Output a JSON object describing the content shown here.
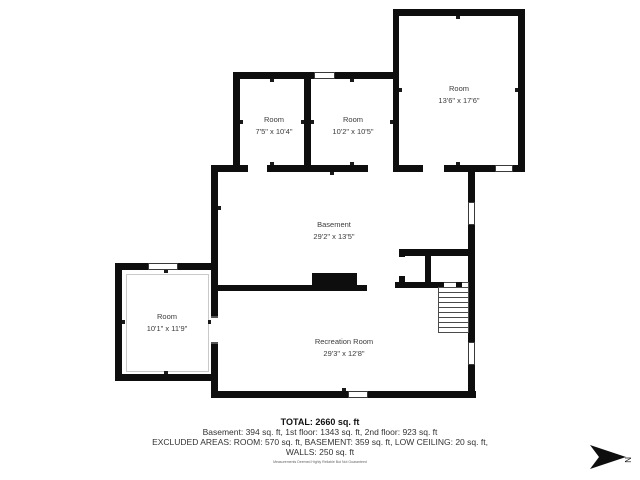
{
  "floorplan": {
    "rooms": [
      {
        "name": "Room",
        "dims": "7'5\" x 10'4\""
      },
      {
        "name": "Room",
        "dims": "10'2\" x 10'5\""
      },
      {
        "name": "Room",
        "dims": "13'6\" x 17'6\""
      },
      {
        "name": "Basement",
        "dims": "29'2\" x 13'5\""
      },
      {
        "name": "Room",
        "dims": "10'1\" x 11'9\""
      },
      {
        "name": "Recreation Room",
        "dims": "29'3\" x 12'8\""
      }
    ],
    "compass_label": "N",
    "colors": {
      "wall": "#0e0e0e",
      "label_text": "#3b3b3b"
    }
  },
  "summary": {
    "total": "TOTAL: 2660 sq. ft",
    "floors": "Basement: 394 sq. ft, 1st floor: 1343 sq. ft, 2nd floor: 923 sq. ft",
    "excluded": "EXCLUDED AREAS: ROOM: 570 sq. ft, BASEMENT: 359 sq. ft, LOW CEILING: 20 sq. ft,",
    "walls": "WALLS: 250 sq. ft",
    "disclaimer": "Measurements Deemed Highly Reliable But Not Guaranteed"
  }
}
